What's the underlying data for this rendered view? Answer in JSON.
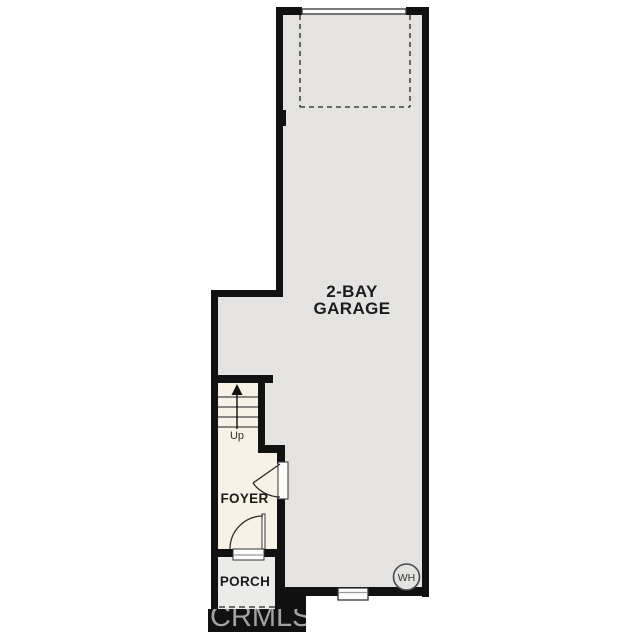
{
  "plan": {
    "garage_label": "2-BAY GARAGE",
    "foyer_label": "FOYER",
    "porch_label": "PORCH",
    "stairs_direction_label": "Up",
    "water_heater_label": "WH",
    "watermark": "CRMLS"
  },
  "colors": {
    "garage-floor": "#e4e3e1",
    "interior-cream": "#f8f1e5",
    "porch-floor": "#ebebe9",
    "wall-black": "#111111",
    "dashed-line": "#222222",
    "watermark-gray": "#bcbcba"
  }
}
